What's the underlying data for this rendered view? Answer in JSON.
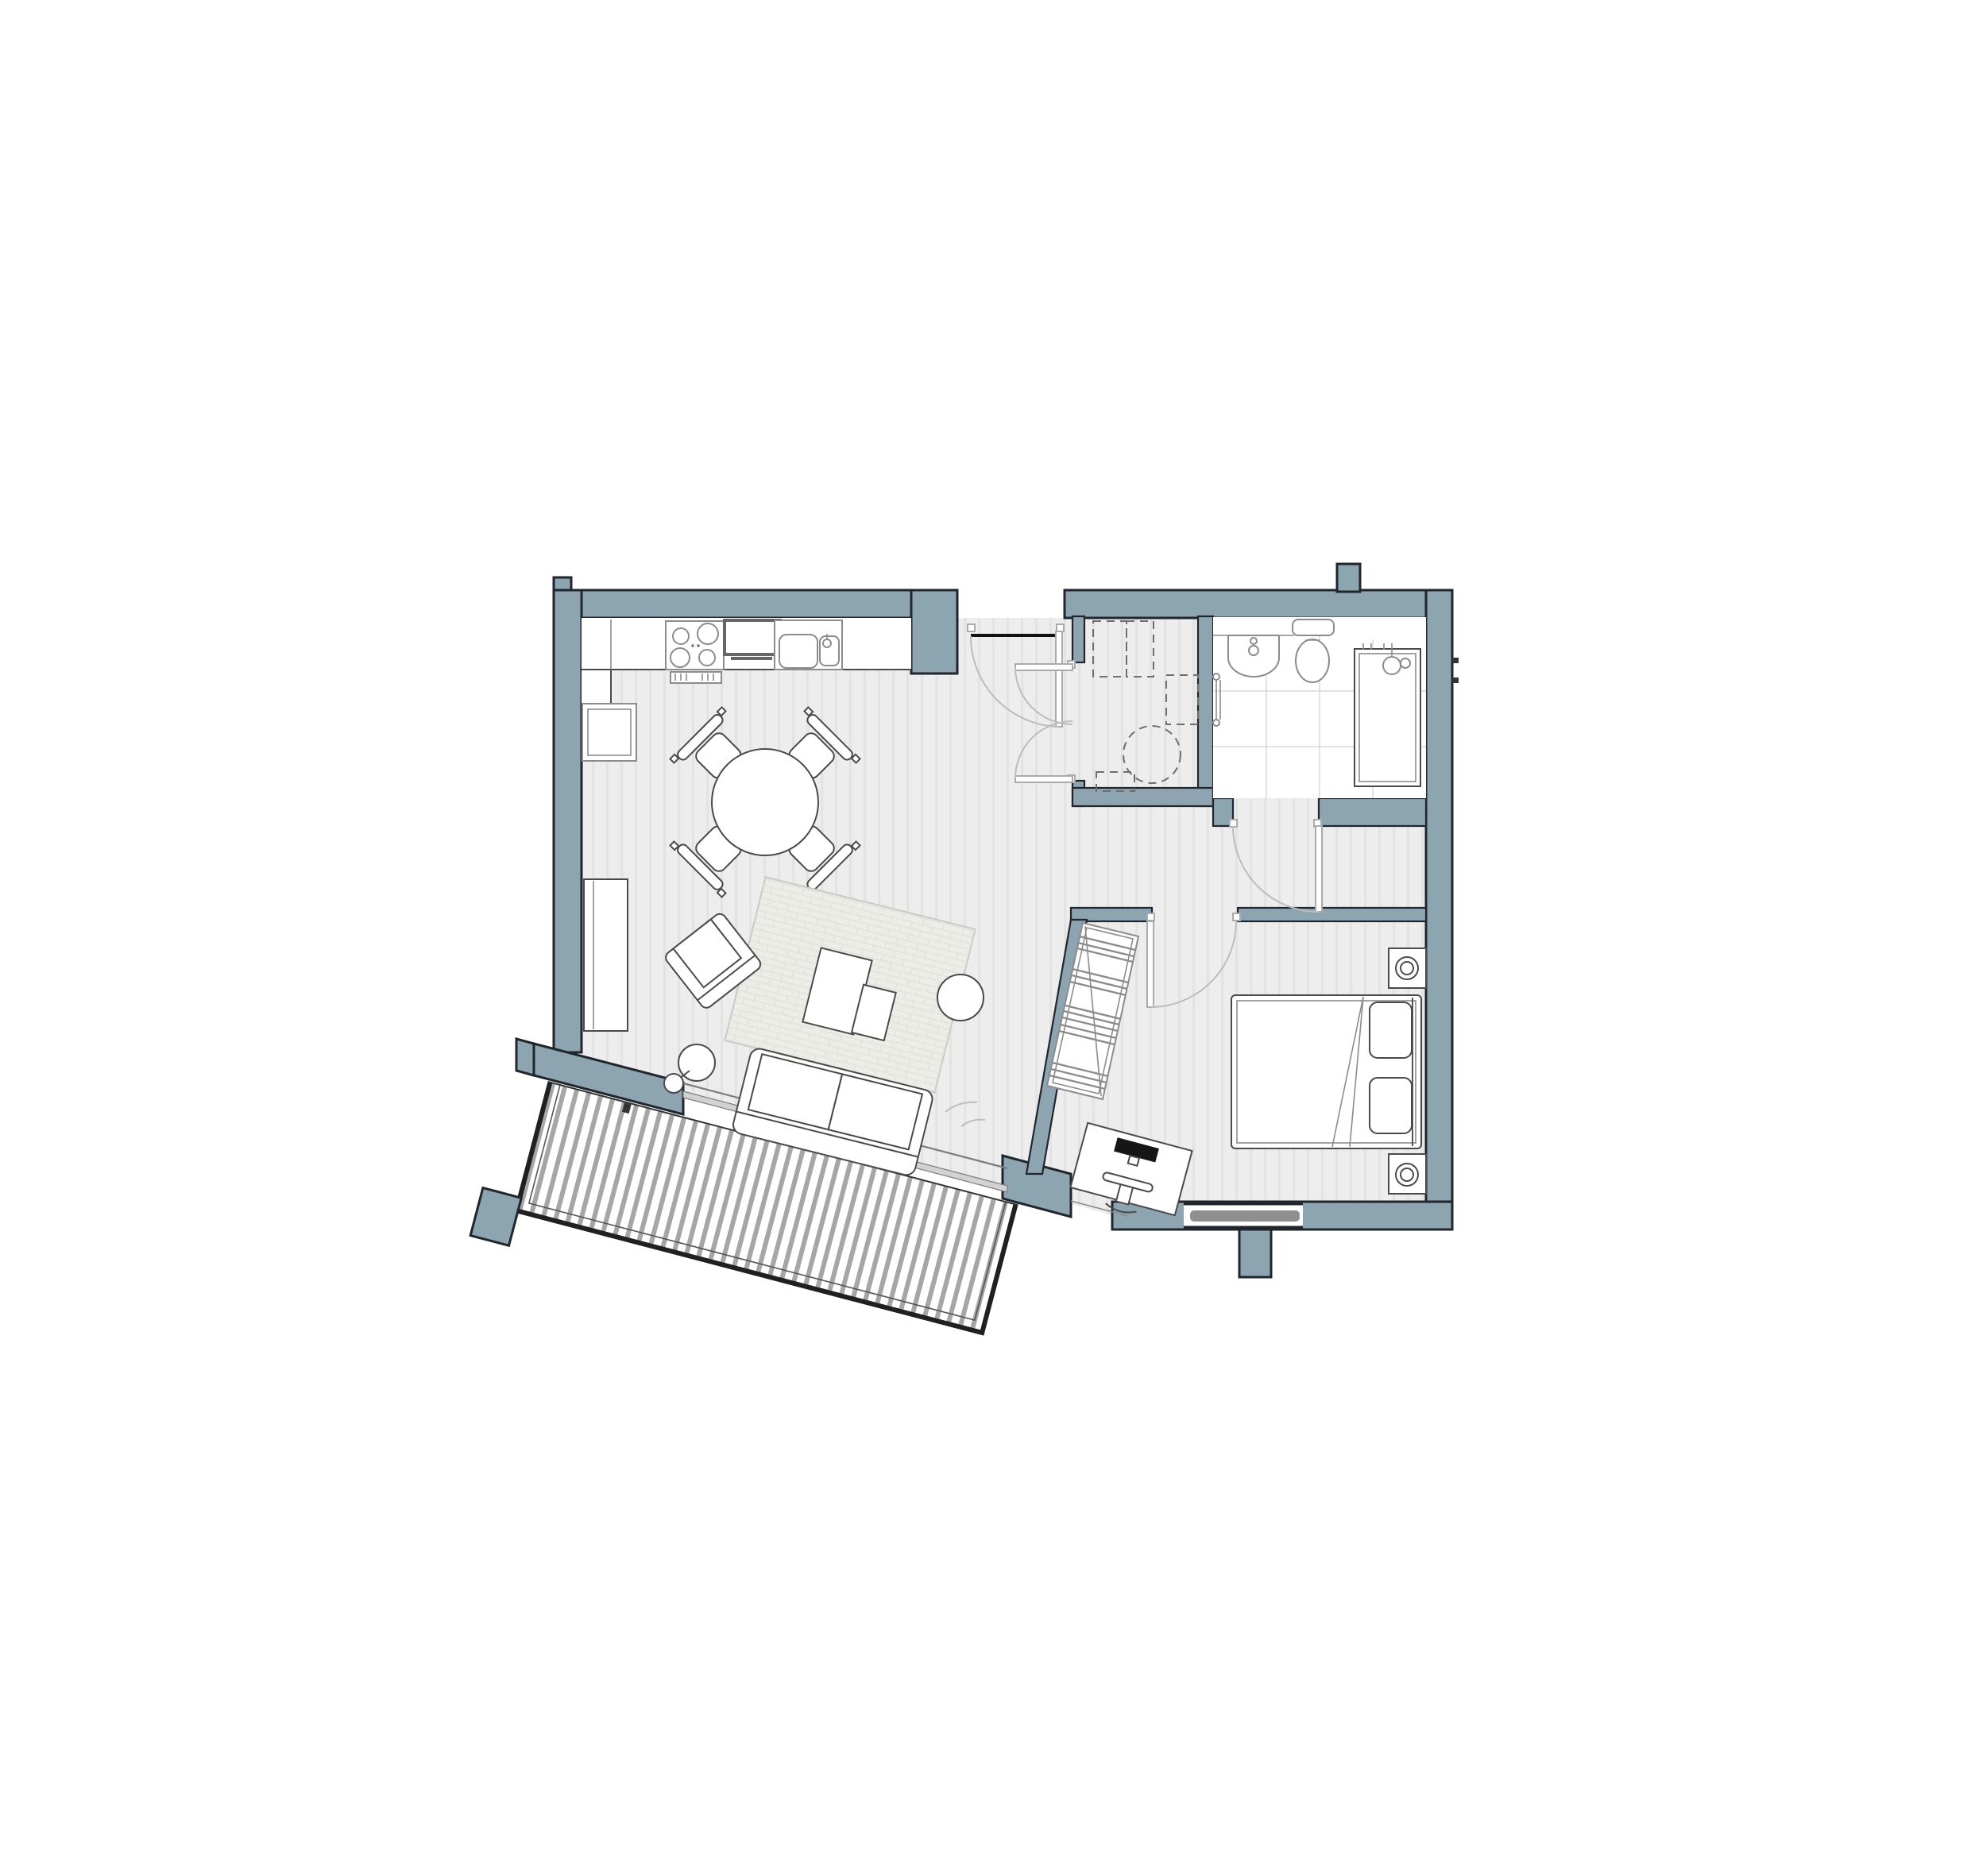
{
  "document": {
    "type": "architectural floor plan",
    "subject": "one-bedroom apartment with angled balcony",
    "visible_text": ""
  },
  "colors": {
    "wall": "#8da4b1",
    "wall_outline": "#20262b",
    "floor": "#ededed",
    "floor_stripe": "#e3e3e3",
    "rug": "#edede8",
    "rug_line": "#e0e0da",
    "deck_stripe": "#a6a6a6",
    "railing": "#202020",
    "fixture_stroke": "#4a4a4a",
    "fixture_light": "#8c8c8c",
    "door_leaf": "#ababab",
    "door_arc": "#bdbdbd",
    "dashed": "#6e6e6e",
    "glass_frame": "#7d7d7d",
    "glass_panel": "#d2d2d2",
    "tile_line": "#d8d8d8",
    "radiator": "#8f8f8f",
    "monitor": "#161616"
  },
  "rooms": [
    {
      "name": "open-plan kitchen / dining / living room",
      "fixtures": [
        "kitchen counter",
        "cooktop with four burners",
        "oven",
        "double sink with tap",
        "tall unit fridge",
        "round dining table",
        "four dining chairs",
        "media unit",
        "armchair",
        "area rug",
        "coffee table pair",
        "round side table",
        "floor lamp",
        "two-seat sofa"
      ]
    },
    {
      "name": "entrance hall",
      "fixtures": [
        "entrance door",
        "utility closet with double doors",
        "dashed appliance outlines",
        "dashed hot-water cylinder"
      ]
    },
    {
      "name": "bathroom",
      "fixtures": [
        "wash basin",
        "toilet with cistern",
        "shower enclosure with shower head",
        "towel rail",
        "tiled floor"
      ]
    },
    {
      "name": "corridor",
      "fixtures": []
    },
    {
      "name": "bedroom with study nook",
      "fixtures": [
        "double bed",
        "two pillows",
        "duvet fold",
        "two bedside tables with lamps",
        "open wardrobe with hanging rail",
        "desk",
        "desk chair",
        "computer monitor",
        "window with radiator"
      ]
    },
    {
      "name": "balcony",
      "fixtures": [
        "timber decking",
        "perimeter railing",
        "sliding glass door"
      ]
    }
  ]
}
